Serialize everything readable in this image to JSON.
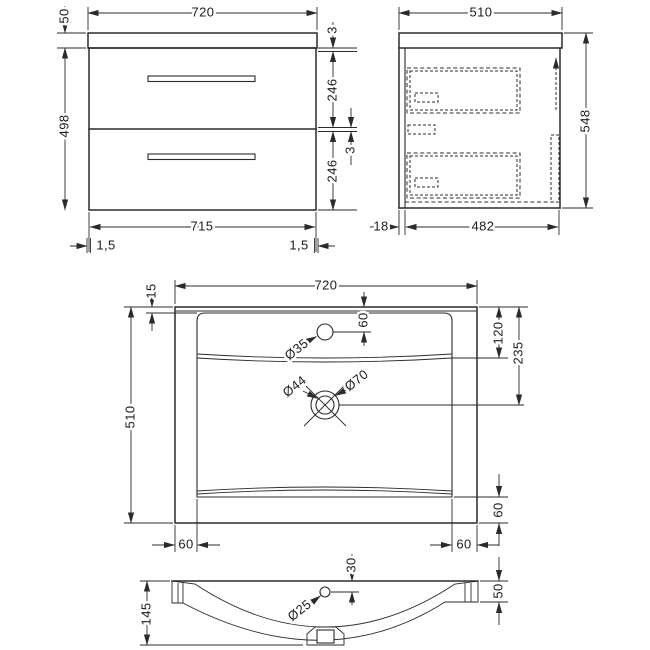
{
  "views": {
    "front": {
      "width_top": "720",
      "worktop_height": "50",
      "body_height": "498",
      "gap_top": "3",
      "drawer1_height": "246",
      "gap_middle": "3",
      "drawer2_height": "246",
      "width_bottom": "715",
      "offset_left": "1,5",
      "offset_right": "1,5"
    },
    "side": {
      "depth_top": "510",
      "height_right": "548",
      "back_offset": "18",
      "body_depth": "482"
    },
    "plan": {
      "width_top": "720",
      "depth_left": "510",
      "back_rim": "15",
      "tap_hole_offset": "60",
      "tap_hole_dia": "Ø35",
      "bowl_back_depth": "120",
      "waste_center_depth": "235",
      "waste_dia_inner": "Ø44",
      "waste_dia_outer": "Ø70",
      "rim_left": "60",
      "rim_right": "60",
      "rim_front": "60"
    },
    "section": {
      "basin_height": "145",
      "overflow_offset": "30",
      "overflow_dia": "Ø25",
      "edge_height": "50"
    }
  }
}
